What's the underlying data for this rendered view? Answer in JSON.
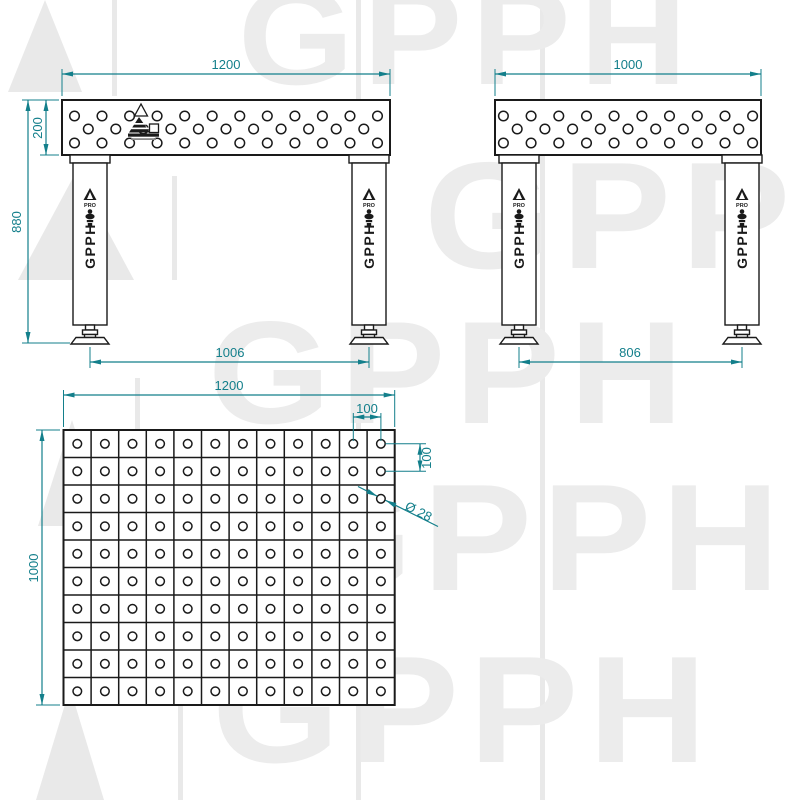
{
  "brand": {
    "name": "GPPH",
    "sub": "PRO"
  },
  "colors": {
    "dimension": "#137f8b",
    "line": "#1a1a1a",
    "watermark": "#ececec"
  },
  "front_view": {
    "dim_width": "1200",
    "dim_top_height": "200",
    "dim_total_height": "880",
    "dim_leg_span": "1006",
    "holes": {
      "top": 12,
      "middle": 11,
      "bottom": 12
    }
  },
  "side_view": {
    "dim_width": "1000",
    "dim_leg_span": "806",
    "holes": {
      "top": 10,
      "middle": 9,
      "bottom": 10
    }
  },
  "top_view": {
    "dim_width": "1200",
    "dim_depth": "1000",
    "dim_spacing_x": "100",
    "dim_spacing_y": "100",
    "dim_hole_diameter": "Ø 28",
    "grid": {
      "cols": 12,
      "rows": 10
    }
  },
  "watermark": {
    "text": "GPPH"
  }
}
